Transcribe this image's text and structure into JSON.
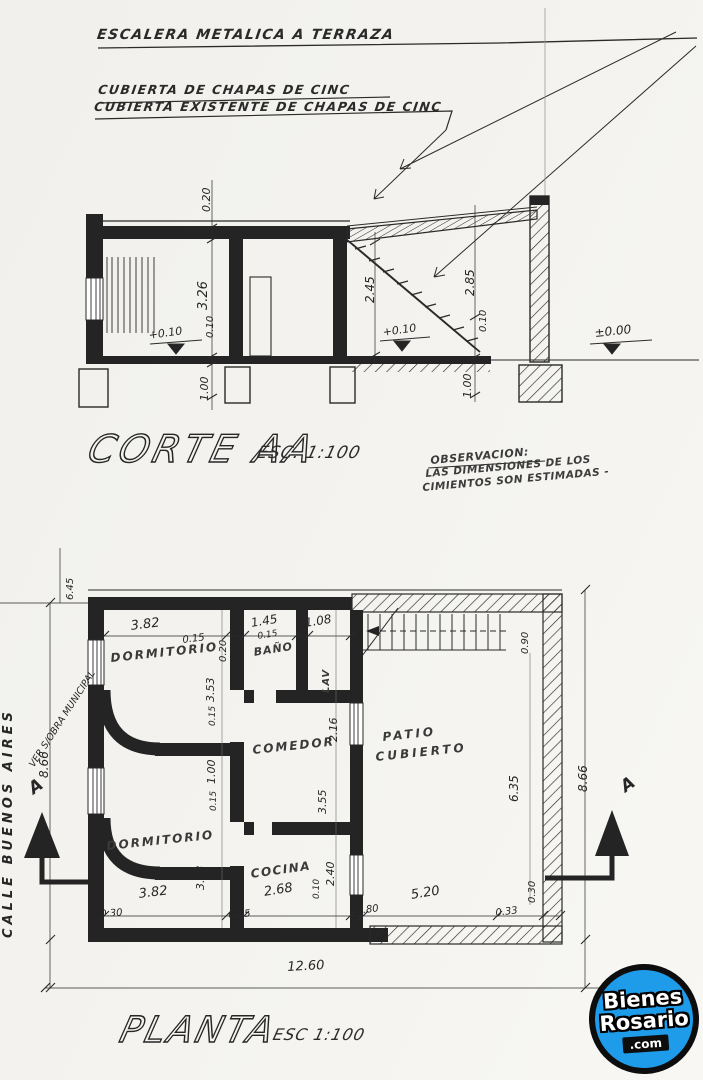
{
  "section": {
    "callouts": {
      "c1": "ESCALERA METALICA A TERRAZA",
      "c2": "CUBIERTA DE CHAPAS DE CINC",
      "c3": "CUBIERTA EXISTENTE DE CHAPAS DE CINC"
    },
    "title": "CORTE AA",
    "scale": "ESC. 1:100",
    "observation": {
      "heading": "OBSERVACION:",
      "line1": "LAS DIMENSIONES DE LOS",
      "line2": "CIMIENTOS SON ESTIMADAS -"
    },
    "dims": {
      "slab": "0.20",
      "height": "3.26",
      "floor": "0.10",
      "level_room": "+0.10",
      "foundation_left": "1.00",
      "patio_left": "2.45",
      "patio_right": "2.85",
      "patio_floor": "0.10",
      "level_patio": "+0.10",
      "foundation_right": "1.00",
      "level_ground": "±0.00"
    }
  },
  "plan": {
    "title": "PLANTA",
    "scale": "ESC 1:100",
    "street": "CALLE BUENOS AIRES",
    "left_note": "VER S/OBRA MUNICIPAL",
    "section_letter": "A",
    "rooms": {
      "bedroom_top": "DORMITORIO",
      "bathroom": "BAÑO",
      "laundry": "LAV",
      "dining": "COMEDOR",
      "patio_line1": "PATIO",
      "patio_line2": "CUBIERTO",
      "bedroom_bottom": "DORMITORIO",
      "kitchen": "COCINA"
    },
    "dims": {
      "setback": "6.45",
      "bed1_w": "3.82",
      "w015a": "0.15",
      "bath_w": "1.45",
      "w015b": "0.15",
      "laundry_w": "1.08",
      "wall020": "0.20",
      "left_total": "8.66",
      "right_total": "8.66",
      "stair": "0.90",
      "patio_h": "6.35",
      "patio_wall": "0.30",
      "bed1_h": "3.53",
      "w015c": "0.15",
      "hall": "1.00",
      "w015d": "0.15",
      "bed2_h": "3.53",
      "dining_a": "2.16",
      "dining_b": "3.55",
      "kitchen_h": "2.40",
      "w010": "0.10",
      "bed2_w": "3.82",
      "b030": "0.30",
      "kitchen_w": "2.68",
      "b015": "0.15",
      "b080": "0.80",
      "patio_w": "5.20",
      "b033": "0.33",
      "total": "12.60"
    }
  },
  "logo": {
    "line1": "Bienes",
    "line2": "Rosario",
    "line3": ".com",
    "blue": "#1e9be9"
  },
  "colors": {
    "ink": "#262626",
    "paper": "#f3f2ee"
  }
}
